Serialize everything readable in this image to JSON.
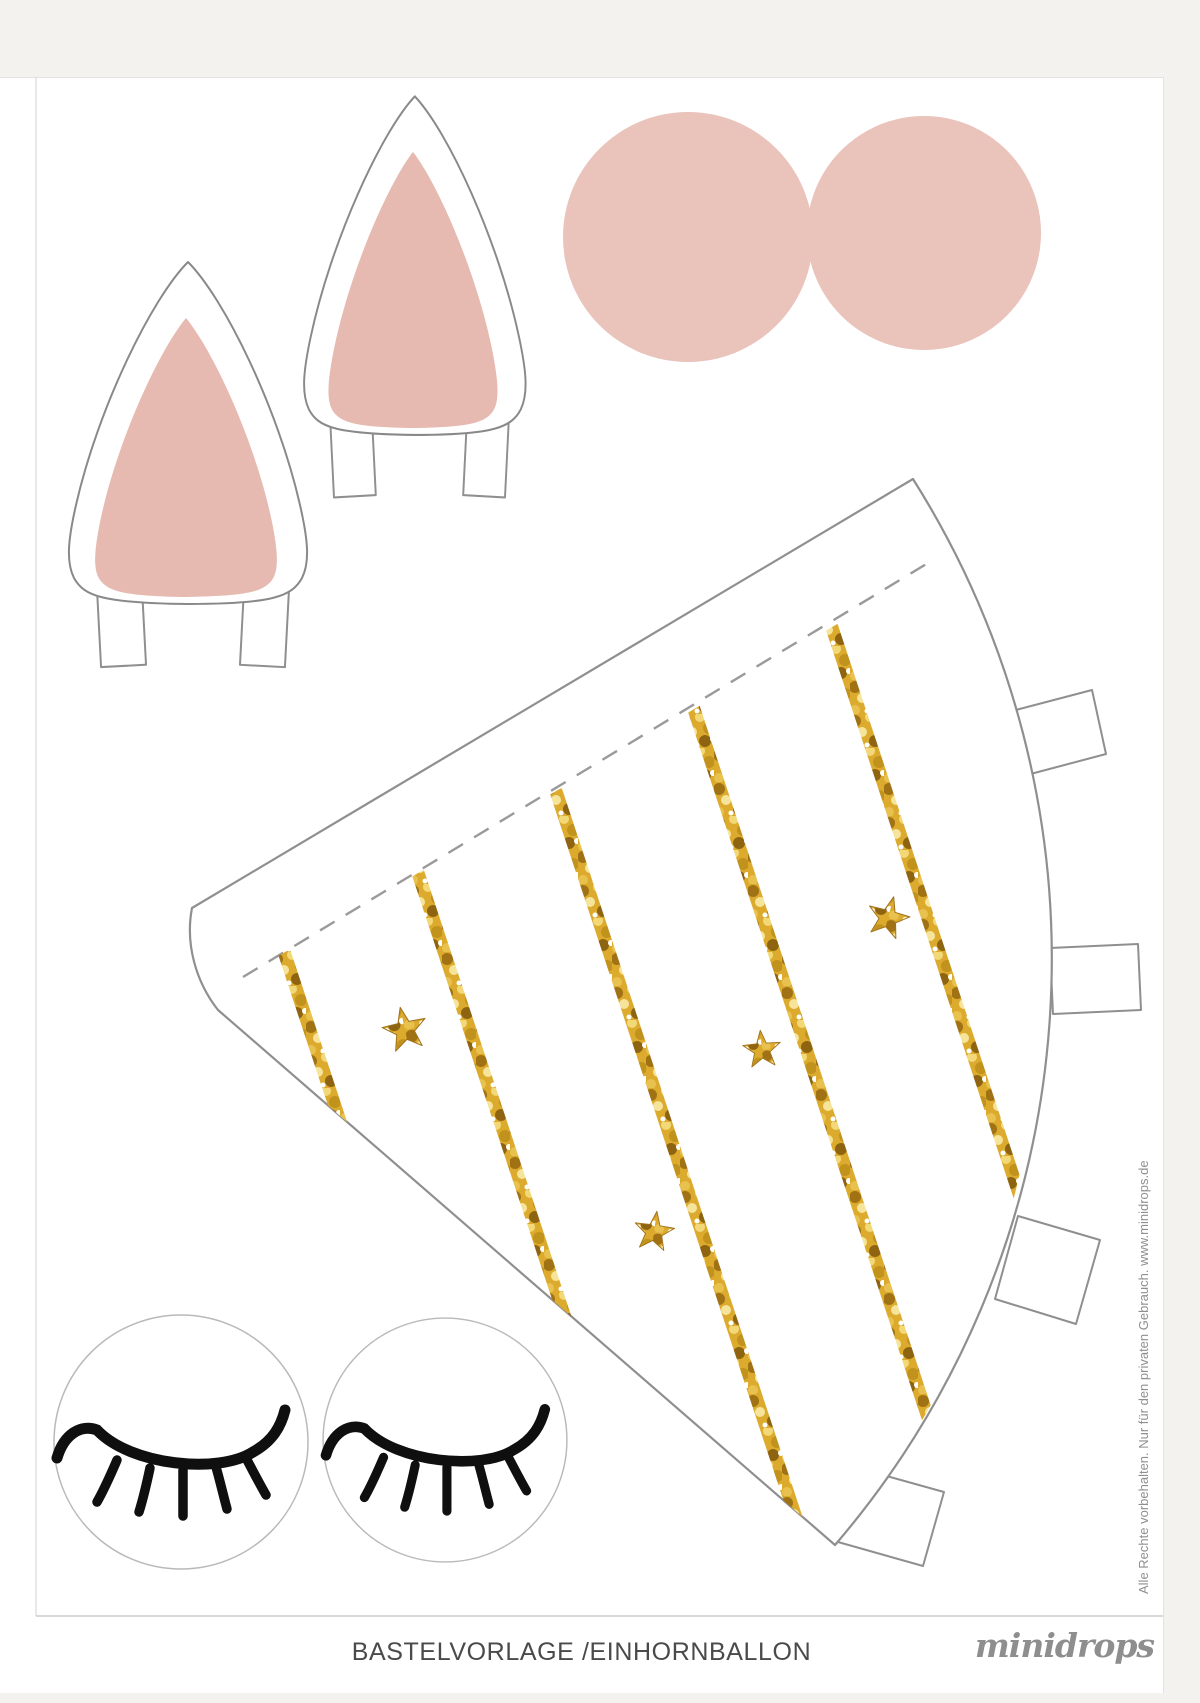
{
  "document": {
    "caption": "BASTELVORLAGE /EINHORNBALLON",
    "brand": "minidrops",
    "copyright_notice": "Alle Rechte vorbehalten. Nur für den privaten Gebrauch. www.minidrops.de"
  },
  "shapes": {
    "ear_left": "unicorn-ear-template-large",
    "ear_right": "unicorn-ear-template-small",
    "circle_left": "pink-circle-blush-left",
    "circle_right": "pink-circle-blush-right",
    "cone": "unicorn-horn-cone-template-gold-stripes",
    "eye_left": "sleepy-eye-circle-left",
    "eye_right": "sleepy-eye-circle-right"
  },
  "colors": {
    "blush_pink": "#EAC3BB",
    "inner_ear_pink": "#E6BAB0",
    "gold": "#DCAB2E",
    "gold_dark": "#A07214",
    "gold_light": "#F3DC82",
    "outline_gray": "#8F8F8F",
    "lash_black": "#0F0F0F",
    "page_white": "#FFFFFF",
    "canvas_gray": "#F3F2EF"
  }
}
